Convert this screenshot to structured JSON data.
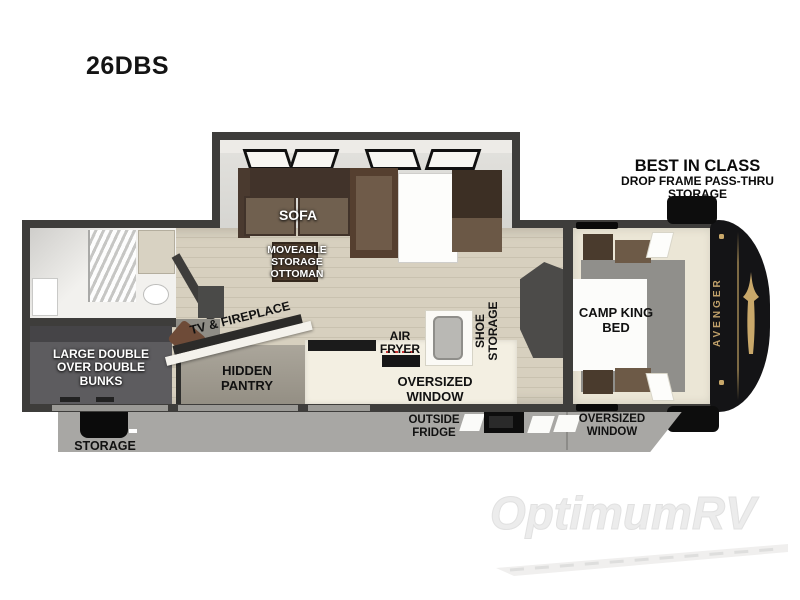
{
  "model_label": "26DBS",
  "callout": {
    "line1": "BEST IN CLASS",
    "line2": "DROP FRAME PASS-THRU",
    "line3": "STORAGE"
  },
  "labels": {
    "sofa": "SOFA",
    "ottoman": "MOVEABLE STORAGE OTTOMAN",
    "tv_fireplace": "TV & FIREPLACE",
    "hidden_pantry": "HIDDEN PANTRY",
    "air_fryer": "AIR FRYER",
    "shoe_storage": "SHOE STORAGE",
    "oversized_window_kitchen": "OVERSIZED WINDOW",
    "bunks": "LARGE DOUBLE OVER DOUBLE BUNKS",
    "camp_king_bed": "CAMP KING BED",
    "storage_exterior": "STORAGE",
    "outside_fridge": "OUTSIDE FRIDGE",
    "oversized_window_bedroom": "OVERSIZED WINDOW",
    "brand_front_cap": "AVENGER"
  },
  "watermark": "OptimumRV",
  "colors": {
    "wall": "#3e3d3b",
    "wood_floor": "#d7d0bf",
    "slide_floor": "#d9d8d4",
    "sofa_brown": "#70604f",
    "sofa_dark": "#41332a",
    "counter_cream": "#f3efe2",
    "bunk_gray": "#5d5c5f",
    "bedroom_floor": "#ebe6d6",
    "front_cap_black": "#141416",
    "brand_gold": "#c9a86a",
    "skirt_gray": "#a8a7a4",
    "label_black": "#111111",
    "label_white": "#ffffff"
  }
}
